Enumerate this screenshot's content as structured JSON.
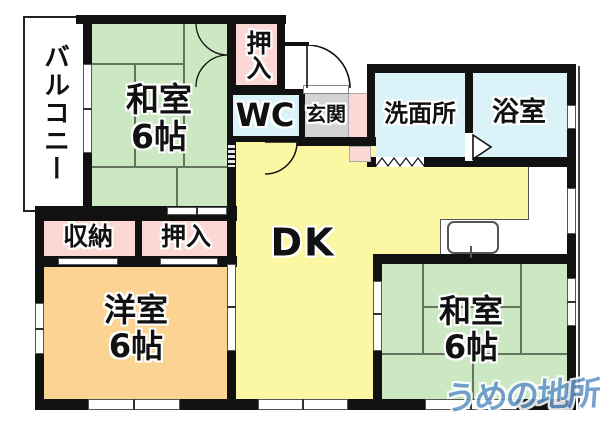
{
  "plan": {
    "rooms": {
      "balcony": {
        "label": "バルコニー"
      },
      "washitsu_tl": {
        "label": "和室",
        "size": "6帖"
      },
      "oshiire_top": {
        "label": "押入"
      },
      "wc": {
        "label": "WC"
      },
      "genkan": {
        "label": "玄関"
      },
      "senmenjo": {
        "label": "洗面所"
      },
      "yokushitsu": {
        "label": "浴室"
      },
      "dk": {
        "label": "DK"
      },
      "shuno": {
        "label": "収納"
      },
      "oshiire_mid": {
        "label": "押入"
      },
      "yoshitsu": {
        "label": "洋室",
        "size": "6帖"
      },
      "washitsu_br": {
        "label": "和室",
        "size": "6帖"
      }
    },
    "watermark": {
      "text": "うめの地所",
      "color": "#6395c8"
    },
    "colors": {
      "wall": "#111111",
      "tatami_green": "#cbe8c2",
      "dk_yellow": "#fbf7a3",
      "western_orange": "#fbd494",
      "closet_pink": "#fbd8d4",
      "water_cyan": "#daf2f8",
      "genkan_gray": "#d3d3d3"
    }
  }
}
